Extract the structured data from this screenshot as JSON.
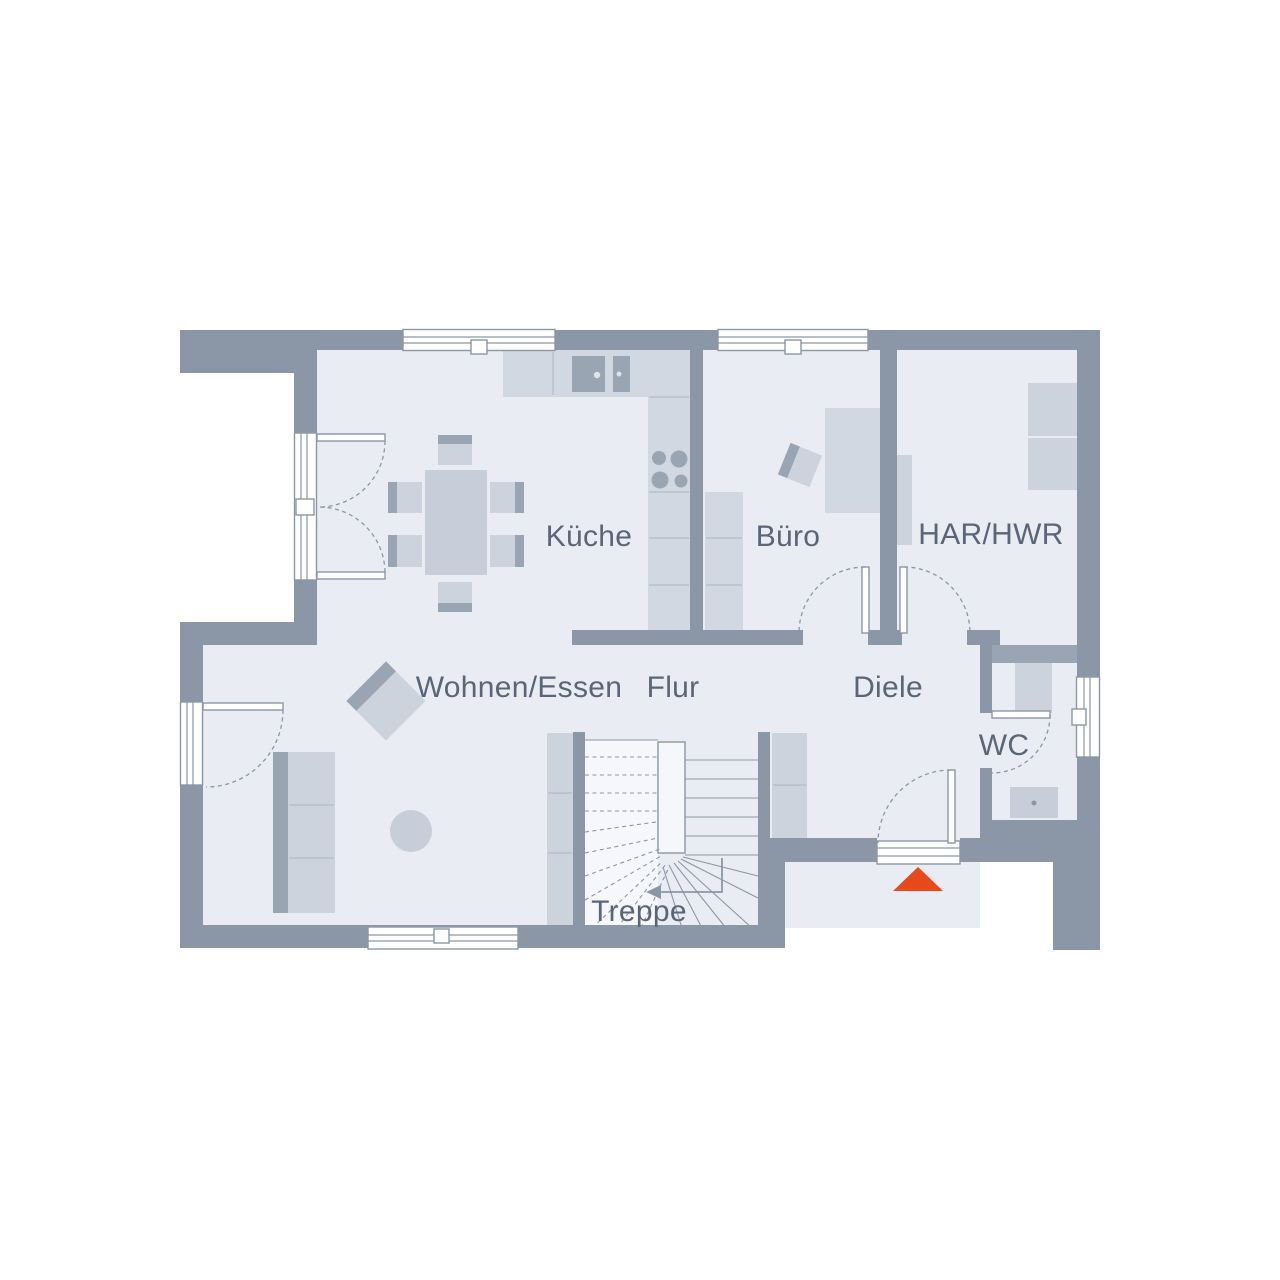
{
  "plan": {
    "rooms": [
      {
        "id": "kueche",
        "label": "Küche"
      },
      {
        "id": "buero",
        "label": "Büro"
      },
      {
        "id": "har_hwr",
        "label": "HAR/HWR"
      },
      {
        "id": "wohnen_essen",
        "label": "Wohnen/Essen"
      },
      {
        "id": "flur",
        "label": "Flur"
      },
      {
        "id": "diele",
        "label": "Diele"
      },
      {
        "id": "wc",
        "label": "WC"
      },
      {
        "id": "treppe",
        "label": "Treppe"
      }
    ],
    "entrance_marker": {
      "shape": "triangle",
      "color": "#e5491c"
    },
    "colors": {
      "wall": "#8b97a6",
      "floor": "#e9ecf2",
      "furniture_light": "#cdd3dd",
      "furniture_dark": "#9aa5b4",
      "label_text": "#5a6577",
      "background": "#ffffff"
    }
  }
}
